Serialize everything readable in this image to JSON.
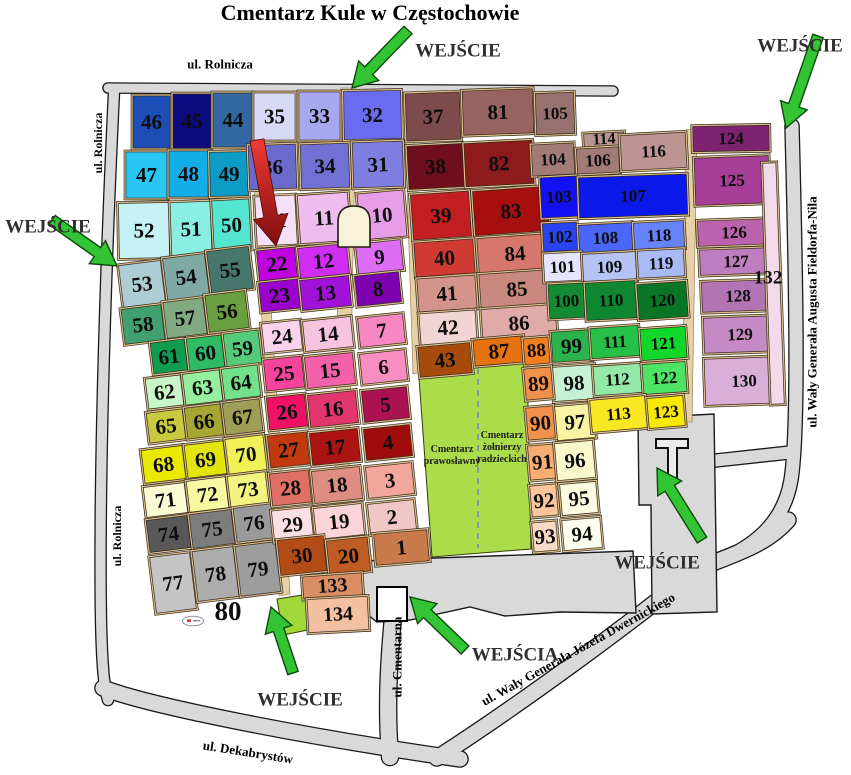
{
  "title": "Cmentarz Kule w Częstochowie",
  "colors": {
    "road_fill": "#d9d9d9",
    "road_edge": "#1a1a1a",
    "alley_tan": "#e7d0a5",
    "cell_edge_dark": "#33291c",
    "cell_edge_tan": "#dec08e",
    "green_arrow": "#33c433",
    "green_arrow_edge": "#0c4a0c",
    "red_arrow_top": "#ef3b34",
    "red_arrow_bottom": "#7e0d0d",
    "entrance_text": "#2f2f2f",
    "street_text": "#000000",
    "zone_green": "#abdc4a",
    "zone_green_small": "#9fd838",
    "chapel_fill": "#f8f2da",
    "building_fill": "#ffffff"
  },
  "roads": [
    {
      "name": "road-rolnicza-top",
      "d": "M108,88 L613,91",
      "w": 9
    },
    {
      "name": "road-rolnicza-left",
      "d": "M114,92 C104,300 99,500 101,620 C102,665 104,688 108,700",
      "w": 10
    },
    {
      "name": "road-dekabrystow",
      "d": "M103,688 C150,706 300,736 460,759",
      "w": 15
    },
    {
      "name": "road-dwernickiego",
      "d": "M437,758 C530,698 645,612 697,569 C735,554 766,545 788,520",
      "w": 15
    },
    {
      "name": "road-fieldorfa-nila",
      "d": "M792,126 C796,280 799,430 791,480 C784,522 755,549 706,566",
      "w": 13
    },
    {
      "name": "road-cmentarna",
      "d": "M393,617 C389,660 386,705 390,757",
      "w": 16
    },
    {
      "name": "road-connector-east",
      "d": "M702,462 L794,452",
      "w": 12
    }
  ],
  "gray_areas": [
    {
      "name": "plaza-south",
      "points": "322,572 350,563 378,560 633,551 636,613 560,612 505,616 470,607 410,620 377,622 350,601 328,582"
    },
    {
      "name": "plaza-east-gate",
      "points": "638,418 714,414 717,612 652,614 651,505 639,505"
    }
  ],
  "alleys": [
    {
      "name": "alley-central",
      "points": "341,88 356,88 347,590 333,590"
    },
    {
      "name": "alley-west",
      "points": "248,95 257,95 290,594 279,596"
    },
    {
      "name": "alley-mid-east",
      "points": "404,92 413,92 422,372 413,374"
    },
    {
      "name": "alley-east",
      "points": "686,130 697,128 692,422 682,422"
    }
  ],
  "zones": [
    {
      "name": "zone-orthodox-soviet",
      "points": "419,378 471,366 473,361 527,356 531,549 432,557",
      "color_key": "zone_green"
    },
    {
      "name": "zone-lime-south",
      "points": "277,599 309,594 313,629 283,635",
      "color_key": "zone_green_small"
    }
  ],
  "zone_labels": [
    {
      "name": "label-cmentarz-prawoslawny",
      "lines": [
        "Cmentarz",
        "prawosławny"
      ],
      "x": 452,
      "y": 452,
      "fs": 10
    },
    {
      "name": "label-cmentarz-zolnierzy",
      "lines": [
        "Cmentarz",
        "żołnierzy",
        "radzieckich"
      ],
      "x": 502,
      "y": 438,
      "fs": 10
    }
  ],
  "streets": [
    {
      "name": "street-rolnicza-top",
      "label": "ul. Rolnicza",
      "x": 220,
      "y": 64,
      "rot": 0,
      "fs": 13
    },
    {
      "name": "street-rolnicza-left-upper",
      "label": "ul. Rolnicza",
      "x": 98,
      "y": 143,
      "rot": -90,
      "fs": 12
    },
    {
      "name": "street-rolnicza-left-lower",
      "label": "ul. Rolnicza",
      "x": 117,
      "y": 536,
      "rot": -90,
      "fs": 12
    },
    {
      "name": "street-cmentarna",
      "label": "ul. Cmentarna",
      "x": 397,
      "y": 657,
      "rot": -90,
      "fs": 13
    },
    {
      "name": "street-dekabrystow",
      "label": "ul. Dekabrystów",
      "x": 248,
      "y": 752,
      "rot": 9,
      "fs": 13
    },
    {
      "name": "street-dwernickiego",
      "label": "ul. Wały Generała Józefa Dwernickiego",
      "x": 578,
      "y": 649,
      "rot": -29,
      "fs": 13
    },
    {
      "name": "street-fieldorfa-nila",
      "label": "ul. Wały Generała Augusta Fieldorfa-Nila",
      "x": 812,
      "y": 312,
      "rot": -90,
      "fs": 13
    }
  ],
  "entrances": [
    {
      "name": "entrance-top",
      "label": "WEJŚCIE",
      "x": 458,
      "y": 51,
      "fs": 19
    },
    {
      "name": "entrance-top-right",
      "label": "WEJŚCIE",
      "x": 800,
      "y": 46,
      "fs": 19
    },
    {
      "name": "entrance-left",
      "label": "WEJŚCIE",
      "x": 48,
      "y": 227,
      "fs": 19
    },
    {
      "name": "entrance-bottom",
      "label": "WEJŚCIE",
      "x": 300,
      "y": 700,
      "fs": 19
    },
    {
      "name": "entrance-bottom-mid",
      "label": "WEJŚCIA",
      "x": 515,
      "y": 655,
      "fs": 19
    },
    {
      "name": "entrance-east",
      "label": "WEJŚCIE",
      "x": 657,
      "y": 563,
      "fs": 19
    }
  ],
  "extra_labels": [
    {
      "name": "label-section-80",
      "text": "80",
      "x": 228,
      "y": 611,
      "fs": 27
    },
    {
      "name": "label-section-132",
      "text": "132",
      "x": 768,
      "y": 278,
      "fs": 19
    }
  ],
  "green_arrows": [
    {
      "name": "arrow-entrance-top",
      "tail": [
        408,
        30
      ],
      "head": [
        352,
        88
      ]
    },
    {
      "name": "arrow-entrance-top-right",
      "tail": [
        818,
        36
      ],
      "head": [
        786,
        128
      ]
    },
    {
      "name": "arrow-entrance-left",
      "tail": [
        52,
        220
      ],
      "head": [
        117,
        266
      ]
    },
    {
      "name": "arrow-entrance-bottom",
      "tail": [
        293,
        673
      ],
      "head": [
        271,
        607
      ]
    },
    {
      "name": "arrow-entrance-bottom-mid",
      "tail": [
        465,
        650
      ],
      "head": [
        410,
        597
      ]
    },
    {
      "name": "arrow-entrance-east",
      "tail": [
        702,
        540
      ],
      "head": [
        657,
        468
      ]
    }
  ],
  "red_arrow": {
    "name": "arrow-highlight-section-21",
    "tail": [
      257,
      140
    ],
    "head": [
      276,
      246
    ]
  },
  "sections": [
    [
      "46",
      "#1d4eb5",
      132,
      95,
      39,
      54,
      0
    ],
    [
      "45",
      "#0c0c80",
      172,
      93,
      40,
      56,
      0
    ],
    [
      "44",
      "#33679f",
      212,
      92,
      42,
      56,
      0
    ],
    [
      "47",
      "#29c6f2",
      125,
      151,
      43,
      48,
      0
    ],
    [
      "48",
      "#13aee8",
      168,
      150,
      41,
      48,
      0
    ],
    [
      "49",
      "#0d9cc6",
      209,
      151,
      40,
      46,
      -1
    ],
    [
      "52",
      "#c5f2f4",
      118,
      202,
      52,
      57,
      -1
    ],
    [
      "51",
      "#8beee2",
      170,
      201,
      42,
      56,
      -2
    ],
    [
      "50",
      "#55e6d2",
      212,
      199,
      39,
      52,
      -3
    ],
    [
      "53",
      "#accdd3",
      120,
      262,
      44,
      44,
      -7
    ],
    [
      "54",
      "#7fa9a5",
      164,
      255,
      44,
      44,
      -7
    ],
    [
      "55",
      "#47766c",
      208,
      248,
      44,
      44,
      -7
    ],
    [
      "58",
      "#41a070",
      122,
      306,
      42,
      37,
      -7
    ],
    [
      "57",
      "#82aa82",
      164,
      299,
      42,
      38,
      -7
    ],
    [
      "56",
      "#699e41",
      206,
      292,
      42,
      39,
      -7
    ],
    [
      "61",
      "#0f9c4e",
      151,
      340,
      36,
      33,
      -7
    ],
    [
      "60",
      "#2fba64",
      187,
      336,
      37,
      34,
      -7
    ],
    [
      "59",
      "#55ca7b",
      224,
      331,
      37,
      35,
      -7
    ],
    [
      "62",
      "#c9f6c9",
      146,
      376,
      37,
      32,
      -7
    ],
    [
      "63",
      "#95ef9f",
      183,
      371,
      39,
      33,
      -7
    ],
    [
      "64",
      "#73e189",
      222,
      366,
      38,
      33,
      -7
    ],
    [
      "65",
      "#c9c940",
      147,
      410,
      38,
      32,
      -7
    ],
    [
      "66",
      "#a6a634",
      185,
      405,
      38,
      33,
      -7
    ],
    [
      "67",
      "#9e9e57",
      223,
      400,
      39,
      34,
      -7
    ],
    [
      "68",
      "#e9e902",
      142,
      447,
      43,
      35,
      -7
    ],
    [
      "69",
      "#e4e40e",
      185,
      442,
      41,
      35,
      -7
    ],
    [
      "70",
      "#f0f057",
      226,
      436,
      40,
      37,
      -7
    ],
    [
      "71",
      "#fbfbd4",
      144,
      484,
      43,
      32,
      -7
    ],
    [
      "72",
      "#f8f8a2",
      187,
      478,
      41,
      33,
      -7
    ],
    [
      "73",
      "#f3f382",
      228,
      473,
      40,
      33,
      -7
    ],
    [
      "74",
      "#585858",
      147,
      517,
      43,
      34,
      -7
    ],
    [
      "75",
      "#7c7c7c",
      190,
      511,
      44,
      36,
      -7
    ],
    [
      "76",
      "#9a9a9a",
      234,
      505,
      40,
      36,
      -7
    ],
    [
      "77",
      "#c5c5c5",
      152,
      554,
      42,
      58,
      -7
    ],
    [
      "78",
      "#acacac",
      194,
      548,
      43,
      52,
      -7
    ],
    [
      "79",
      "#9d9d9d",
      237,
      543,
      42,
      52,
      -7
    ],
    [
      "35",
      "#d7d7f6",
      253,
      92,
      43,
      49,
      0
    ],
    [
      "33",
      "#a8a8f0",
      298,
      91,
      43,
      50,
      0
    ],
    [
      "32",
      "#6b6bf0",
      343,
      90,
      59,
      50,
      -1
    ],
    [
      "36",
      "#6a6acd",
      248,
      144,
      49,
      46,
      -2
    ],
    [
      "34",
      "#7171d3",
      300,
      143,
      50,
      46,
      -2
    ],
    [
      "31",
      "#7e7edf",
      352,
      141,
      52,
      47,
      -2
    ],
    [
      "21",
      "#f3e0f6",
      255,
      195,
      42,
      51,
      -3
    ],
    [
      "11",
      "#eebcee",
      298,
      193,
      52,
      50,
      -4
    ],
    [
      "10",
      "#e69ce6",
      358,
      191,
      48,
      48,
      -5
    ],
    [
      "22",
      "#c002e0",
      257,
      248,
      40,
      32,
      -6
    ],
    [
      "12",
      "#cf2ef2",
      298,
      245,
      51,
      32,
      -6
    ],
    [
      "9",
      "#dd6ef4",
      356,
      241,
      47,
      32,
      -6
    ],
    [
      "23",
      "#9b02cd",
      259,
      280,
      41,
      31,
      -6
    ],
    [
      "13",
      "#a112d8",
      300,
      277,
      51,
      32,
      -6
    ],
    [
      "8",
      "#7c02b0",
      355,
      273,
      46,
      32,
      -6
    ],
    [
      "24",
      "#f9d3eb",
      262,
      321,
      40,
      31,
      -6
    ],
    [
      "14",
      "#f7c4df",
      303,
      318,
      50,
      32,
      -6
    ],
    [
      "7",
      "#f888c4",
      358,
      315,
      47,
      31,
      -6
    ],
    [
      "25",
      "#f5449c",
      264,
      357,
      40,
      33,
      -6
    ],
    [
      "15",
      "#f361aa",
      305,
      354,
      50,
      33,
      -6
    ],
    [
      "6",
      "#f68ec2",
      360,
      351,
      47,
      32,
      -6
    ],
    [
      "26",
      "#f01065",
      267,
      395,
      40,
      34,
      -6
    ],
    [
      "16",
      "#e2366e",
      308,
      392,
      50,
      34,
      -6
    ],
    [
      "5",
      "#ac1252",
      362,
      388,
      47,
      33,
      -6
    ],
    [
      "27",
      "#c33a11",
      268,
      433,
      41,
      34,
      -6
    ],
    [
      "17",
      "#ac1313",
      310,
      430,
      50,
      34,
      -6
    ],
    [
      "4",
      "#9e0c0c",
      364,
      426,
      48,
      33,
      -6
    ],
    [
      "28",
      "#e07065",
      270,
      471,
      41,
      34,
      -6
    ],
    [
      "18",
      "#de8d83",
      312,
      468,
      50,
      34,
      -6
    ],
    [
      "3",
      "#f3a69c",
      366,
      464,
      48,
      33,
      -6
    ],
    [
      "29",
      "#fcdee5",
      272,
      508,
      41,
      33,
      -6
    ],
    [
      "19",
      "#fad4d9",
      314,
      505,
      50,
      33,
      -6
    ],
    [
      "2",
      "#efc7c5",
      368,
      501,
      48,
      32,
      -6
    ],
    [
      "30",
      "#b34b17",
      278,
      537,
      48,
      37,
      -6
    ],
    [
      "20",
      "#be5c24",
      327,
      538,
      43,
      36,
      -6
    ],
    [
      "1",
      "#ca7b4b",
      374,
      531,
      55,
      33,
      -5
    ],
    [
      "133",
      "#da8e63",
      302,
      574,
      61,
      24,
      -4,
      20
    ],
    [
      "134",
      "#f3c0a1",
      307,
      597,
      62,
      35,
      -3,
      20
    ],
    [
      "37",
      "#7d4b4b",
      405,
      92,
      56,
      49,
      -2
    ],
    [
      "81",
      "#976360",
      462,
      89,
      72,
      46,
      -2
    ],
    [
      "105",
      "#967170",
      535,
      92,
      40,
      43,
      -2
    ],
    [
      "38",
      "#6f0f1d",
      407,
      144,
      57,
      45,
      -3
    ],
    [
      "82",
      "#8d1b1b",
      464,
      141,
      70,
      45,
      -3
    ],
    [
      "104",
      "#a27b77",
      531,
      143,
      44,
      33,
      -3
    ],
    [
      "114",
      "#bb9492",
      583,
      132,
      42,
      15,
      -3,
      16
    ],
    [
      "106",
      "#a27b77",
      576,
      147,
      44,
      27,
      -3
    ],
    [
      "116",
      "#bc9492",
      620,
      133,
      67,
      37,
      -3
    ],
    [
      "39",
      "#c31e21",
      411,
      192,
      60,
      47,
      -4
    ],
    [
      "83",
      "#a70e0e",
      473,
      188,
      76,
      46,
      -4
    ],
    [
      "40",
      "#cf3b32",
      414,
      240,
      61,
      36,
      -4
    ],
    [
      "84",
      "#d5776d",
      477,
      235,
      76,
      37,
      -4
    ],
    [
      "41",
      "#d5948b",
      417,
      276,
      60,
      35,
      -4
    ],
    [
      "85",
      "#c9897f",
      479,
      271,
      76,
      36,
      -4
    ],
    [
      "42",
      "#f1d4d4",
      419,
      311,
      58,
      33,
      -4
    ],
    [
      "86",
      "#e0aaa8",
      481,
      306,
      76,
      34,
      -4
    ],
    [
      "43",
      "#a74b0d",
      418,
      344,
      54,
      32,
      -5
    ],
    [
      "87",
      "#e6710f",
      473,
      337,
      52,
      28,
      -5
    ],
    [
      "103",
      "#1310f1",
      540,
      176,
      38,
      42,
      -3
    ],
    [
      "107",
      "#0a18e9",
      578,
      175,
      110,
      42,
      -2
    ],
    [
      "102",
      "#2844f0",
      542,
      222,
      36,
      30,
      -3
    ],
    [
      "108",
      "#4b67f9",
      578,
      223,
      55,
      30,
      -3
    ],
    [
      "118",
      "#6783f9",
      633,
      221,
      52,
      29,
      -3
    ],
    [
      "101",
      "#e5e5fb",
      543,
      252,
      39,
      30,
      -3
    ],
    [
      "109",
      "#b5c3f7",
      582,
      252,
      55,
      30,
      -3
    ],
    [
      "119",
      "#a9b9f3",
      637,
      249,
      48,
      29,
      -3
    ],
    [
      "100",
      "#138b35",
      548,
      283,
      37,
      36,
      -3
    ],
    [
      "110",
      "#0f8731",
      585,
      281,
      52,
      39,
      -3
    ],
    [
      "120",
      "#0b7527",
      637,
      282,
      51,
      37,
      -4
    ],
    [
      "99",
      "#2bb24d",
      551,
      330,
      41,
      32,
      -4
    ],
    [
      "111",
      "#25c047",
      590,
      326,
      50,
      32,
      -4
    ],
    [
      "121",
      "#10d72a",
      640,
      327,
      47,
      33,
      -4
    ],
    [
      "98",
      "#c7f0d3",
      552,
      365,
      44,
      36,
      -4
    ],
    [
      "112",
      "#94e9a9",
      593,
      364,
      49,
      31,
      -4
    ],
    [
      "122",
      "#4de364",
      642,
      362,
      45,
      32,
      -4
    ],
    [
      "97",
      "#f8f4a3",
      555,
      404,
      40,
      36,
      -5
    ],
    [
      "113",
      "#f8e722",
      590,
      397,
      57,
      34,
      -5
    ],
    [
      "123",
      "#f9e902",
      647,
      396,
      38,
      32,
      -5
    ],
    [
      "88",
      "#f17e1f",
      523,
      337,
      27,
      28,
      -5,
      19
    ],
    [
      "89",
      "#f1904a",
      524,
      367,
      29,
      33,
      -5
    ],
    [
      "90",
      "#f1914d",
      526,
      406,
      29,
      34,
      -5
    ],
    [
      "91",
      "#f7ac72",
      528,
      444,
      29,
      36,
      -5
    ],
    [
      "92",
      "#fac59b",
      530,
      484,
      28,
      33,
      -5
    ],
    [
      "93",
      "#f7dac4",
      532,
      521,
      26,
      31,
      -5
    ],
    [
      "96",
      "#f8f8cc",
      555,
      441,
      40,
      39,
      -5
    ],
    [
      "95",
      "#fbfbe1",
      560,
      482,
      38,
      33,
      -5
    ],
    [
      "94",
      "#fdfdef",
      562,
      518,
      40,
      32,
      -5
    ],
    [
      "124",
      "#7d2371",
      692,
      125,
      78,
      27,
      -1
    ],
    [
      "125",
      "#a73e97",
      694,
      156,
      76,
      49,
      -2
    ],
    [
      "126",
      "#bc63ae",
      697,
      219,
      74,
      27,
      -2
    ],
    [
      "127",
      "#be7dbe",
      699,
      248,
      74,
      27,
      -2
    ],
    [
      "128",
      "#b374b3",
      701,
      280,
      74,
      32,
      -2
    ],
    [
      "129",
      "#c58ac5",
      703,
      316,
      74,
      37,
      -2
    ],
    [
      "130",
      "#d9afd9",
      704,
      357,
      80,
      48,
      -2
    ],
    [
      "",
      "#f3daeb",
      766,
      162,
      15,
      243,
      -2
    ]
  ]
}
